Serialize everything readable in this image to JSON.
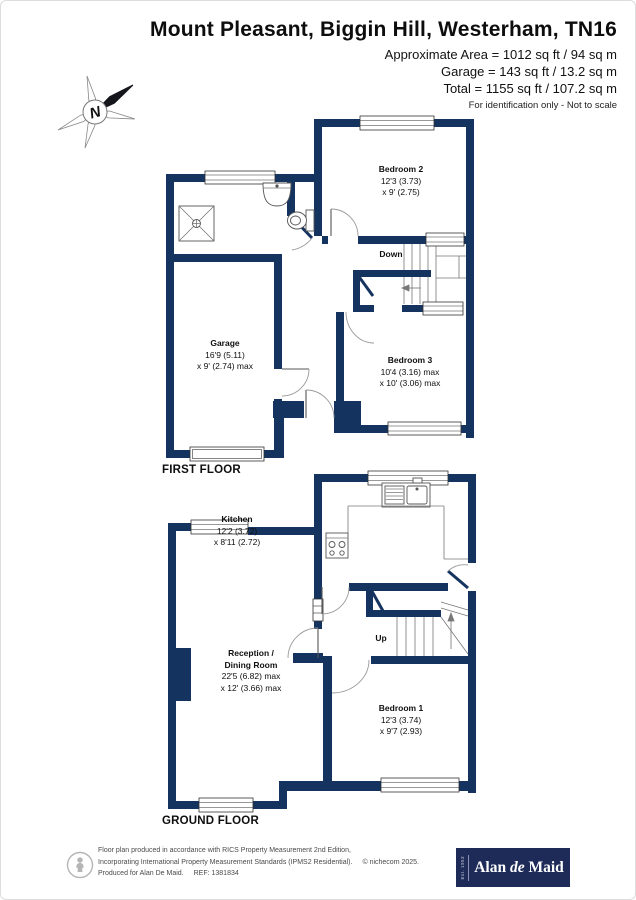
{
  "header": {
    "title": "Mount Pleasant, Biggin Hill, Westerham, TN16",
    "area_lines": [
      "Approximate Area = 1012 sq ft / 94 sq m",
      "Garage = 143 sq ft / 13.2 sq m",
      "Total = 1155 sq ft / 107.2 sq m"
    ],
    "note": "For identification only - Not to scale"
  },
  "compass": {
    "north_label": "N"
  },
  "first_floor": {
    "floor_label": "FIRST FLOOR",
    "stairs_label": "Down",
    "rooms": {
      "bedroom2": {
        "name": "Bedroom 2",
        "dim1": "12'3 (3.73)",
        "dim2": "x 9' (2.75)"
      },
      "garage": {
        "name": "Garage",
        "dim1": "16'9 (5.11)",
        "dim2": "x 9' (2.74) max"
      },
      "bedroom3": {
        "name": "Bedroom 3",
        "dim1": "10'4 (3.16) max",
        "dim2": "x 10' (3.06) max"
      }
    }
  },
  "ground_floor": {
    "floor_label": "GROUND FLOOR",
    "stairs_label": "Up",
    "rooms": {
      "kitchen": {
        "name": "Kitchen",
        "dim1": "12'2 (3.72)",
        "dim2": "x 8'11 (2.72)"
      },
      "reception": {
        "name": "Reception /",
        "name2": "Dining Room",
        "dim1": "22'5 (6.82) max",
        "dim2": "x 12' (3.66) max"
      },
      "bedroom1": {
        "name": "Bedroom 1",
        "dim1": "12'3 (3.74)",
        "dim2": "x 9'7 (2.93)"
      }
    }
  },
  "footer": {
    "line1": "Floor plan produced in accordance with RICS Property Measurement 2nd Edition,",
    "line2": "Incorporating International Property Measurement Standards (IPMS2 Residential).",
    "copyright": "© nichecom 2025.",
    "line3": "Produced for Alan De Maid.",
    "ref": "REF: 1381834",
    "logo": {
      "est": "Est. 1953",
      "name_part1": "Alan ",
      "name_part2": "de",
      "name_part3": " Maid"
    }
  },
  "colors": {
    "wall": "#14335E",
    "logo_bg": "#1E2B58"
  }
}
